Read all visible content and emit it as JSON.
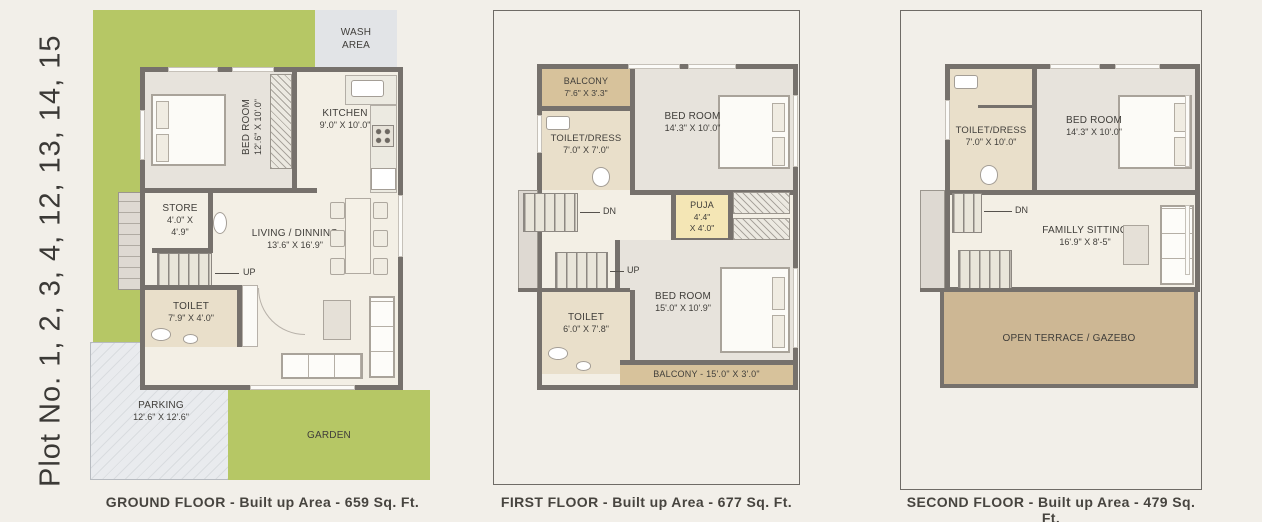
{
  "plot_label": "Plot No. 1, 2, 3, 4, 12, 13, 14, 15",
  "colors": {
    "page_bg": "#f2efe9",
    "plot_green": "#b6c765",
    "wall": "#76716c",
    "room_cream": "#f3efe5",
    "bedroom_gray": "#e7e3dc",
    "toilet_beige": "#e9dfca",
    "balcony_tan": "#d7c29b",
    "terrace_tan": "#cdb794",
    "puja_yellow": "#f4e6b5",
    "wash_gray": "#e2e4e7",
    "parking_gray": "#e9ebee",
    "text": "#3d3b37"
  },
  "icons": [
    "bed-icon",
    "pillow-icon",
    "wc-icon",
    "washbasin-icon",
    "sink-icon",
    "stove-icon",
    "geyser-icon",
    "sofa-icon",
    "coffee-table-icon",
    "dining-table-icon",
    "chair-icon",
    "stairs-icon",
    "door-arc-icon",
    "window",
    "wardrobe-hatch"
  ],
  "ground": {
    "caption": "GROUND FLOOR - Built up Area - 659 Sq. Ft.",
    "wash_area": {
      "line1": "WASH",
      "line2": "AREA"
    },
    "bedroom": {
      "name": "BED ROOM",
      "dims": "12'.6\" X 10'.0\""
    },
    "kitchen": {
      "name": "KITCHEN",
      "dims": "9'.0\" X 10'.0\""
    },
    "store": {
      "name": "STORE",
      "dims1": "4'.0\" X",
      "dims2": "4'.9\""
    },
    "stairs": {
      "up": "UP"
    },
    "toilet": {
      "name": "TOILET",
      "dims": "7'.9\" X 4'.0\""
    },
    "living": {
      "name": "LIVING / DINNING",
      "dims": "13'.6\" X 16'.9\""
    },
    "parking": {
      "name": "PARKING",
      "dims": "12'.6\" X 12'.6\""
    },
    "garden": {
      "name": "GARDEN"
    }
  },
  "first": {
    "caption": "FIRST FLOOR - Built up Area - 677 Sq. Ft.",
    "balcony": {
      "name": "BALCONY",
      "dims": "7'.6\" X 3'.3\""
    },
    "toilet_dress": {
      "name": "TOILET/DRESS",
      "dims": "7'.0\" X 7'.0\""
    },
    "bedroom1": {
      "name": "BED ROOM",
      "dims": "14'.3\" X 10'.0\""
    },
    "puja": {
      "name": "PUJA",
      "dims1": "4'.4\"",
      "dims2": "X 4'.0\""
    },
    "stairs": {
      "dn": "DN",
      "up": "UP"
    },
    "toilet": {
      "name": "TOILET",
      "dims": "6'.0\" X 7'.8\""
    },
    "bedroom2": {
      "name": "BED ROOM",
      "dims": "15'.0\" X 10'.9\""
    },
    "balcony2": {
      "label": "BALCONY - 15'.0\" X 3'.0\""
    }
  },
  "second": {
    "caption": "SECOND FLOOR - Built up Area - 479 Sq. Ft.",
    "toilet_dress": {
      "name": "TOILET/DRESS",
      "dims": "7'.0\" X 10'.0\""
    },
    "bedroom": {
      "name": "BED ROOM",
      "dims": "14'.3\" X 10'.0\""
    },
    "stairs": {
      "dn": "DN"
    },
    "family": {
      "name": "FAMILLY SITTING",
      "dims": "16'.9\" X 8'-5\""
    },
    "terrace": {
      "name": "OPEN TERRACE / GAZEBO"
    }
  }
}
